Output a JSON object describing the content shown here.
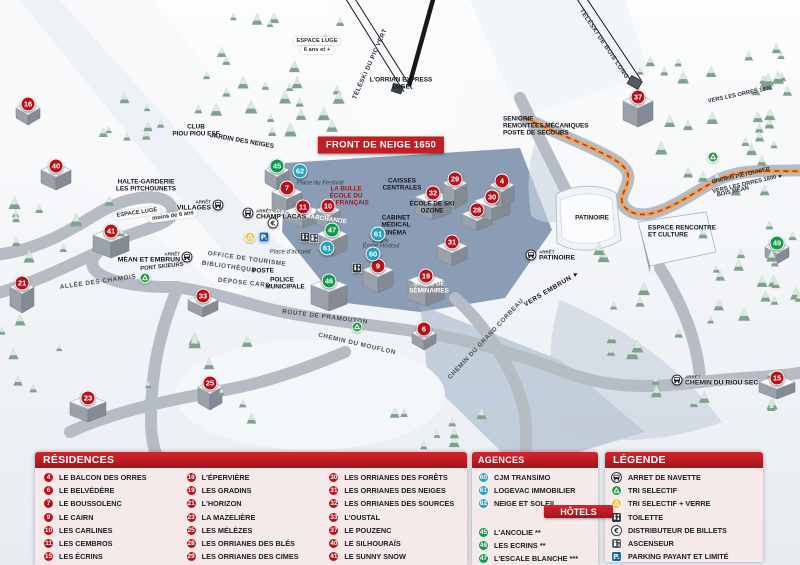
{
  "colors": {
    "residence": "#b5121b",
    "agence": "#2aa0bf",
    "hotel": "#0f9b49",
    "header_red": "#c01f26",
    "panel_bg": "#f5e9e9",
    "parking_blue": "#1a63b5",
    "path_orange": "#f0a24f"
  },
  "map": {
    "banner": {
      "text": "FRONT DE NEIGE 1650",
      "x": 381,
      "y": 145
    },
    "arret_label": "ARRÊT",
    "markers": [
      {
        "n": "16",
        "t": "res",
        "x": 28,
        "y": 104
      },
      {
        "n": "40",
        "t": "res",
        "x": 56,
        "y": 166
      },
      {
        "n": "41",
        "t": "res",
        "x": 111,
        "y": 231
      },
      {
        "n": "21",
        "t": "res",
        "x": 22,
        "y": 283
      },
      {
        "n": "33",
        "t": "res",
        "x": 203,
        "y": 296
      },
      {
        "n": "23",
        "t": "res",
        "x": 88,
        "y": 398
      },
      {
        "n": "25",
        "t": "res",
        "x": 210,
        "y": 383
      },
      {
        "n": "7",
        "t": "res",
        "x": 287,
        "y": 188
      },
      {
        "n": "11",
        "t": "res",
        "x": 303,
        "y": 207
      },
      {
        "n": "10",
        "t": "res",
        "x": 328,
        "y": 206
      },
      {
        "n": "9",
        "t": "res",
        "x": 378,
        "y": 266
      },
      {
        "n": "19",
        "t": "res",
        "x": 426,
        "y": 276
      },
      {
        "n": "6",
        "t": "res",
        "x": 424,
        "y": 329
      },
      {
        "n": "31",
        "t": "res",
        "x": 452,
        "y": 242
      },
      {
        "n": "32",
        "t": "res",
        "x": 433,
        "y": 193
      },
      {
        "n": "29",
        "t": "res",
        "x": 455,
        "y": 179
      },
      {
        "n": "28",
        "t": "res",
        "x": 477,
        "y": 210
      },
      {
        "n": "30",
        "t": "res",
        "x": 492,
        "y": 197
      },
      {
        "n": "4",
        "t": "res",
        "x": 502,
        "y": 181
      },
      {
        "n": "37",
        "t": "res",
        "x": 638,
        "y": 97
      },
      {
        "n": "15",
        "t": "res",
        "x": 777,
        "y": 378
      },
      {
        "n": "45",
        "t": "hot",
        "x": 277,
        "y": 166
      },
      {
        "n": "47",
        "t": "hot",
        "x": 332,
        "y": 230
      },
      {
        "n": "46",
        "t": "hot",
        "x": 329,
        "y": 281
      },
      {
        "n": "49",
        "t": "hot",
        "x": 777,
        "y": 243
      },
      {
        "n": "62",
        "t": "ag",
        "x": 300,
        "y": 171
      },
      {
        "n": "61",
        "t": "ag",
        "x": 378,
        "y": 234
      },
      {
        "n": "61",
        "t": "ag",
        "x": 327,
        "y": 248
      },
      {
        "n": "60",
        "t": "ag",
        "x": 373,
        "y": 254
      }
    ],
    "labels": [
      {
        "t": "TÉLÉSKI DU PIC VERT",
        "x": 370,
        "y": 64,
        "r": -66,
        "s": "lift"
      },
      {
        "t": "TÉLÉSKI DE BOIS LONG",
        "x": 604,
        "y": 44,
        "r": 56,
        "s": "lift"
      },
      {
        "t": "L'ORRIAN EXPRESS",
        "x": 401,
        "y": 80,
        "s": "bld"
      },
      {
        "t": "LUGE",
        "x": 401,
        "y": 87,
        "s": "bld"
      },
      {
        "t": "ESPACE LUGE",
        "x": 317,
        "y": 41,
        "s": "bubble"
      },
      {
        "t": "6 ans et +",
        "x": 317,
        "y": 50,
        "s": "bubble"
      },
      {
        "t": "LAVERIE",
        "x": 410,
        "y": 148,
        "s": "bld"
      },
      {
        "t": "SENIORIE",
        "x": 503,
        "y": 119,
        "s": "bld",
        "a": "l"
      },
      {
        "t": "REMONTÉES MÉCANIQUES",
        "x": 503,
        "y": 126,
        "s": "bld",
        "a": "l"
      },
      {
        "t": "POSTE DE SECOURS",
        "x": 503,
        "y": 133,
        "s": "bld",
        "a": "l"
      },
      {
        "t": "CAISSES",
        "x": 402,
        "y": 181,
        "s": "bld"
      },
      {
        "t": "CENTRALES",
        "x": 402,
        "y": 188,
        "s": "bld"
      },
      {
        "t": "ÉCOLE DE SKI",
        "x": 432,
        "y": 204,
        "s": "bld"
      },
      {
        "t": "OZONE",
        "x": 432,
        "y": 211,
        "s": "bld"
      },
      {
        "t": "LA BULLE",
        "x": 346,
        "y": 189,
        "s": "red"
      },
      {
        "t": "ÉCOLE DU",
        "x": 346,
        "y": 196,
        "s": "red"
      },
      {
        "t": "SKI FRANÇAIS",
        "x": 346,
        "y": 203,
        "s": "red"
      },
      {
        "t": "CABINET",
        "x": 396,
        "y": 218,
        "s": "bld"
      },
      {
        "t": "MÉDICAL",
        "x": 396,
        "y": 225,
        "s": "bld"
      },
      {
        "t": "CINÉMA",
        "x": 394,
        "y": 233,
        "s": "bld"
      },
      {
        "t": "Place du Festival",
        "x": 320,
        "y": 183,
        "s": "place"
      },
      {
        "t": "Place",
        "x": 381,
        "y": 241,
        "s": "place"
      },
      {
        "t": "Émile Hodoul",
        "x": 381,
        "y": 246,
        "s": "place"
      },
      {
        "t": "Place d'accueil",
        "x": 290,
        "y": 252,
        "s": "place"
      },
      {
        "t": "GALERIE MARCHANDE",
        "x": 311,
        "y": 217,
        "r": 8,
        "s": "white"
      },
      {
        "t": "HALTE-GARDERIE",
        "x": 146,
        "y": 182,
        "s": "bld"
      },
      {
        "t": "LES PITCHOUNETS",
        "x": 146,
        "y": 189,
        "s": "bld"
      },
      {
        "t": "ESPACE LUGE",
        "x": 137,
        "y": 213,
        "r": -8,
        "s": "bubble"
      },
      {
        "t": "moins de 6 ans",
        "x": 173,
        "y": 216,
        "r": -8,
        "s": "bubble"
      },
      {
        "t": "CLUB",
        "x": 196,
        "y": 127,
        "s": "bld"
      },
      {
        "t": "PIOU PIOU ESF",
        "x": 196,
        "y": 134,
        "s": "bld"
      },
      {
        "t": "JARDIN DES NEIGES",
        "x": 242,
        "y": 141,
        "r": 10,
        "s": "bld"
      },
      {
        "t": "ALLÉE DES CHAMOIS",
        "x": 98,
        "y": 282,
        "r": -8,
        "s": "road"
      },
      {
        "t": "PONT SKIEURS",
        "x": 162,
        "y": 267,
        "r": -6,
        "s": "tiny"
      },
      {
        "t": "ROUTE DE PRAMOUTON",
        "x": 325,
        "y": 317,
        "r": 7,
        "s": "road"
      },
      {
        "t": "CHEMIN DU MOUFLON",
        "x": 357,
        "y": 344,
        "r": 13,
        "s": "road"
      },
      {
        "t": "CHEMIN DU GRAND CORBEAU",
        "x": 486,
        "y": 339,
        "r": -47,
        "s": "road"
      },
      {
        "t": "VERS EMBRUN ►",
        "x": 552,
        "y": 289,
        "r": -31,
        "s": "dir"
      },
      {
        "t": "CHEMIN PIÉTONNIER",
        "x": 741,
        "y": 176,
        "r": -13,
        "s": "tiny"
      },
      {
        "t": "VERS LES ORRES 1800 ►",
        "x": 748,
        "y": 184,
        "r": -13,
        "s": "tiny"
      },
      {
        "t": "BOIS MÉAN",
        "x": 733,
        "y": 192,
        "r": -13,
        "s": "tiny"
      },
      {
        "t": "VERS LES ORRES 1800",
        "x": 740,
        "y": 95,
        "r": -12,
        "s": "tiny"
      },
      {
        "t": "PATINOIRE",
        "x": 592,
        "y": 218,
        "s": "bld"
      },
      {
        "t": "ESPACE RENCONTRE",
        "x": 648,
        "y": 228,
        "s": "bld",
        "a": "l"
      },
      {
        "t": "ET CULTURE",
        "x": 648,
        "y": 235,
        "s": "bld",
        "a": "l"
      },
      {
        "t": "OFFICE DE TOURISME",
        "x": 247,
        "y": 259,
        "r": 8,
        "s": "road"
      },
      {
        "t": "BIBLIOTHÈQUE",
        "x": 229,
        "y": 267,
        "r": 8,
        "s": "road"
      },
      {
        "t": "POSTE",
        "x": 263,
        "y": 271,
        "s": "bld"
      },
      {
        "t": "DÉPOSE CARS",
        "x": 244,
        "y": 283,
        "r": 6,
        "s": "road"
      },
      {
        "t": "POLICE",
        "x": 282,
        "y": 280,
        "s": "bld"
      },
      {
        "t": "MUNICIPALE",
        "x": 285,
        "y": 287,
        "s": "bld"
      },
      {
        "t": "SALLE DE",
        "x": 429,
        "y": 284,
        "s": "white"
      },
      {
        "t": "SÉMINAIRES",
        "x": 429,
        "y": 291,
        "s": "white"
      }
    ],
    "stops": [
      {
        "label": "VILLAGES",
        "ix": 218,
        "iy": 205,
        "tx": 211,
        "ty": 206,
        "a": "r"
      },
      {
        "label": "CHAMP LACAS",
        "ix": 248,
        "iy": 213,
        "tx": 256,
        "ty": 215,
        "a": "l"
      },
      {
        "label": "MÉAN ET EMBRUN",
        "ix": 187,
        "iy": 257,
        "tx": 180,
        "ty": 258,
        "a": "r"
      },
      {
        "label": "PATINOIRE",
        "ix": 531,
        "iy": 255,
        "tx": 539,
        "ty": 256,
        "a": "l"
      },
      {
        "label": "CHEMIN DU RIOU SEC",
        "ix": 677,
        "iy": 380,
        "tx": 685,
        "ty": 381,
        "a": "l"
      }
    ],
    "icons": [
      {
        "icon": "euro",
        "x": 273,
        "y": 223
      },
      {
        "icon": "recycle-yellow",
        "x": 250,
        "y": 237
      },
      {
        "icon": "parking",
        "x": 264,
        "y": 237
      },
      {
        "icon": "toilette",
        "x": 305,
        "y": 237
      },
      {
        "icon": "elevator",
        "x": 314,
        "y": 238
      },
      {
        "icon": "toilette",
        "x": 357,
        "y": 268
      },
      {
        "icon": "recycle-green",
        "x": 145,
        "y": 278
      },
      {
        "icon": "recycle-green",
        "x": 357,
        "y": 327
      },
      {
        "icon": "recycle-green",
        "x": 713,
        "y": 157
      }
    ]
  },
  "panels": {
    "residences": {
      "title": "RÉSIDENCES",
      "items": [
        {
          "num": "4",
          "label": "LE BALCON DES ORRES"
        },
        {
          "num": "6",
          "label": "LE BELVÉDÈRE"
        },
        {
          "num": "7",
          "label": "LE BOUSSOLENC"
        },
        {
          "num": "9",
          "label": "LE CAIRN"
        },
        {
          "num": "10",
          "label": "LES CARLINES"
        },
        {
          "num": "11",
          "label": "LES CEMBROS"
        },
        {
          "num": "15",
          "label": "LES ÉCRINS"
        },
        {
          "num": "16",
          "label": "L'ÉPERVIÈRE"
        },
        {
          "num": "19",
          "label": "LES GRADINS"
        },
        {
          "num": "21",
          "label": "L'HORIZON"
        },
        {
          "num": "23",
          "label": "LA MAZELIÈRE"
        },
        {
          "num": "25",
          "label": "LES MÉLÈZES"
        },
        {
          "num": "28",
          "label": "LES ORRIANES DES BLÉS"
        },
        {
          "num": "29",
          "label": "LES ORRIANES DES CIMES"
        },
        {
          "num": "30",
          "label": "LES ORRIANES DES FORÊTS"
        },
        {
          "num": "31",
          "label": "LES ORRIANES DES NEIGES"
        },
        {
          "num": "32",
          "label": "LES ORRIANES DES SOURCES"
        },
        {
          "num": "33",
          "label": "L'OUSTAL"
        },
        {
          "num": "37",
          "label": "LE POUZENC"
        },
        {
          "num": "40",
          "label": "LE SILHOURAÏS"
        },
        {
          "num": "41",
          "label": "LE SUNNY SNOW"
        }
      ]
    },
    "agences": {
      "title": "AGENCES IMMOBILIÈRES",
      "items": [
        {
          "num": "60",
          "label": "CJM TRANSIMO"
        },
        {
          "num": "61",
          "label": "LOGEVAC IMMOBILIER"
        },
        {
          "num": "62",
          "label": "NEIGE ET SOLEIL"
        }
      ]
    },
    "hotels": {
      "title": "HÔTELS",
      "items": [
        {
          "num": "45",
          "label": "L'ANCOLIE **"
        },
        {
          "num": "46",
          "label": "LES ECRINS **"
        },
        {
          "num": "47",
          "label": "L'ESCALE BLANCHE ***"
        },
        {
          "num": "49",
          "label": "LES TRAPPEURS **"
        }
      ]
    },
    "legende": {
      "title": "LÉGENDE",
      "items": [
        {
          "icon": "bus",
          "label": "ARRET DE NAVETTE"
        },
        {
          "icon": "recycle-green",
          "label": "TRI SELECTIF"
        },
        {
          "icon": "recycle-yellow",
          "label": "TRI SELECTIF + VERRE"
        },
        {
          "icon": "toilette",
          "label": "TOILETTE"
        },
        {
          "icon": "euro",
          "label": "DISTRIBUTEUR DE BILLETS"
        },
        {
          "icon": "elevator",
          "label": "ASCENSEUR"
        },
        {
          "icon": "parking",
          "label": "PARKING PAYANT ET LIMITÉ"
        }
      ]
    }
  }
}
